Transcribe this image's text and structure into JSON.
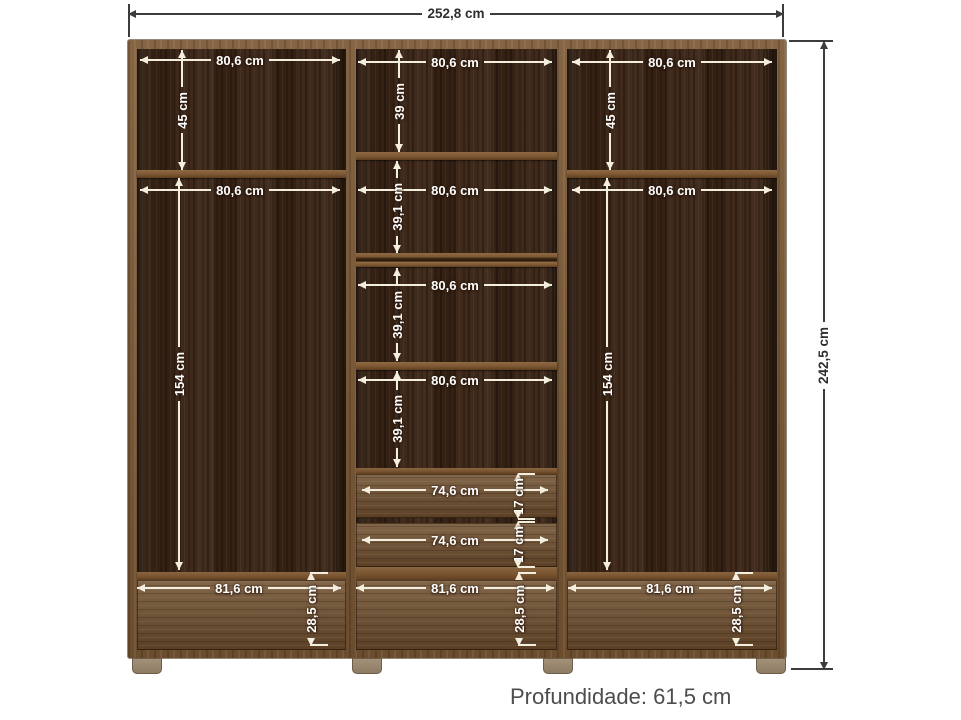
{
  "diagram": {
    "subject": "wardrobe-internal-dimensions-front-view",
    "caption": "Profundidade: 61,5 cm"
  },
  "colors": {
    "frame_wood": "#7a5733",
    "interior_wood": "#3b2516",
    "drawer_wood": "#6f4e2d",
    "feet": "#98866f",
    "dimension_line_inner": "#f3eedd",
    "dimension_line_outer": "#3c3c3c",
    "caption_text": "#4d4d4d",
    "background": "#ffffff"
  },
  "dims": {
    "overall": {
      "width": "252,8 cm",
      "height": "242,5 cm"
    },
    "left": {
      "top_width": "80,6 cm",
      "top_height": "45 cm",
      "mid_width": "80,6 cm",
      "hang_height": "154 cm",
      "base_width": "81,6 cm",
      "base_height": "28,5 cm"
    },
    "middle": {
      "c1_width": "80,6 cm",
      "c1_height": "39 cm",
      "c2_width": "80,6 cm",
      "c2_height": "39,1 cm",
      "c3_width": "80,6 cm",
      "c3_height": "39,1 cm",
      "c4_width": "80,6 cm",
      "c4_height": "39,1 cm",
      "d1_width": "74,6 cm",
      "d1_height": "17 cm",
      "d2_width": "74,6 cm",
      "d2_height": "17 cm",
      "base_width": "81,6 cm",
      "base_height": "28,5 cm"
    },
    "right": {
      "top_width": "80,6 cm",
      "top_height": "45 cm",
      "mid_width": "80,6 cm",
      "hang_height": "154 cm",
      "base_width": "81,6 cm",
      "base_height": "28,5 cm"
    }
  }
}
